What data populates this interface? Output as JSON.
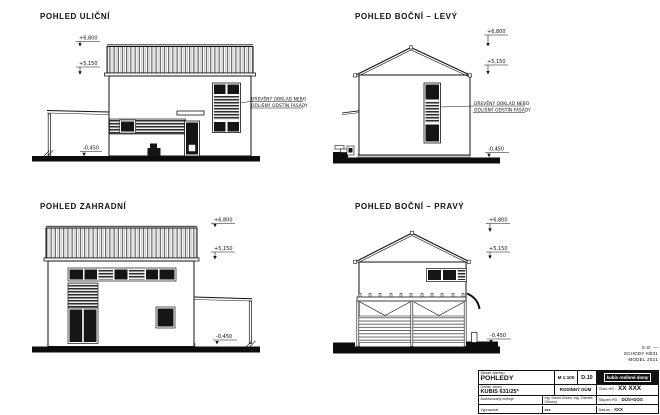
{
  "sheet": {
    "views": {
      "street": {
        "title": "POHLED ULIČNÍ",
        "dims": {
          "top": "+6,800",
          "mid": "+5,150",
          "ground": "-0,450"
        },
        "annotation_line1": "DŘEVĚNÝ OBKLAD NEBO",
        "annotation_line2": "ODLIŠNÝ ODSTÍN FASÁDY"
      },
      "side_left": {
        "title": "POHLED BOČNÍ – LEVÝ",
        "dims": {
          "top": "+6,800",
          "mid": "+5,150",
          "ground": "-0,450"
        },
        "annotation_line1": "DŘEVĚNÝ OBKLAD NEBO",
        "annotation_line2": "ODLIŠNÝ ODSTÍN FASÁDY"
      },
      "garden": {
        "title": "POHLED ZAHRADNÍ",
        "dims": {
          "top": "+6,800",
          "mid": "+5,150",
          "ground": "-0,450"
        }
      },
      "side_right": {
        "title": "POHLED BOČNÍ – PRAVÝ",
        "dims": {
          "top": "+6,800",
          "mid": "+5,150",
          "ground": "-0,450"
        }
      }
    },
    "note": {
      "line1": "S.O. —",
      "line2": "SCHODY KB31",
      "line3": "MODEL 2021"
    },
    "titleblock": {
      "content_label": "Obsah výkresu",
      "content_value": "POHLEDY",
      "scale": "M 1:100",
      "drawing_no": "D.10",
      "logo_text": "kubis rodinné domy",
      "house_label": "Označ. domu",
      "house_value": "KUBIS 631/25*",
      "building_type": "RODINNÝ DŮM",
      "hs_label": "Číslo HS :",
      "hs_value": "XX XXX",
      "engineer_label": "Autorizovaný inženýr",
      "engineer_value": "Ing. David Ondra, Ing. Zdeněk Chromý",
      "stage_label": "Stupeň PD :",
      "stage_value": "DÚS+DOS",
      "author_label": "Vypracoval",
      "author_value": "xxx",
      "date_label": "Datum :",
      "date_value": "XXX"
    }
  }
}
